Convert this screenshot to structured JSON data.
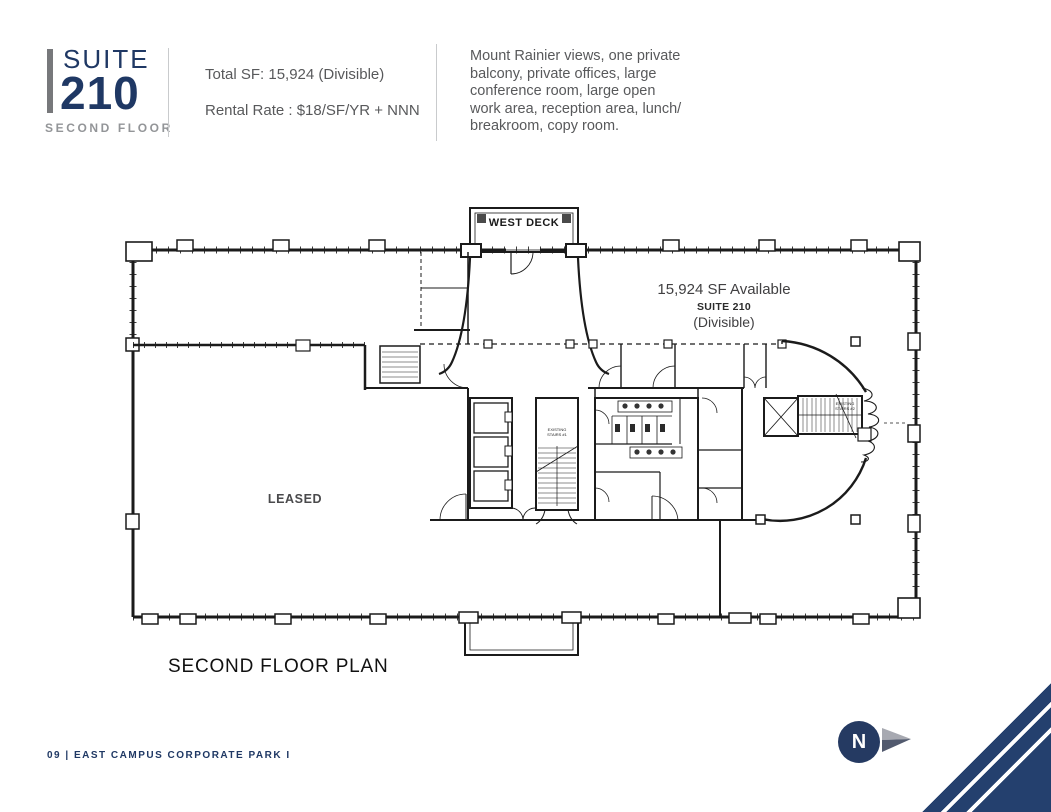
{
  "header": {
    "suite_label": "SUITE",
    "suite_number": "210",
    "floor_label": "SECOND FLOOR",
    "total_sf": "Total SF: 15,924 (Divisible)",
    "rental_rate": "Rental Rate : $18/SF/YR + NNN",
    "description_lines": [
      "Mount Rainier views, one private",
      "balcony, private offices, large",
      "conference room, large open",
      "work area, reception area, lunch/",
      "breakroom, copy room."
    ]
  },
  "plan": {
    "west_deck": "WEST DECK",
    "available_sf": "15,924 SF Available",
    "available_suite": "SUITE 210",
    "available_divisible": "(Divisible)",
    "leased": "LEASED",
    "title": "SECOND FLOOR PLAN",
    "stairs1_line1": "EXISTING",
    "stairs1_line2": "STAIRS #1",
    "stairs2_line1": "EXISTING",
    "stairs2_line2": "STAIRS #2"
  },
  "footer": {
    "page_label": "09 | EAST CAMPUS CORPORATE PARK I",
    "north_label": "N"
  },
  "colors": {
    "navy": "#1f3864",
    "accent_bar_gray": "#77787b",
    "body_text_gray": "#58595b",
    "muted_gray": "#939598",
    "plan_line": "#1b1b1b"
  }
}
